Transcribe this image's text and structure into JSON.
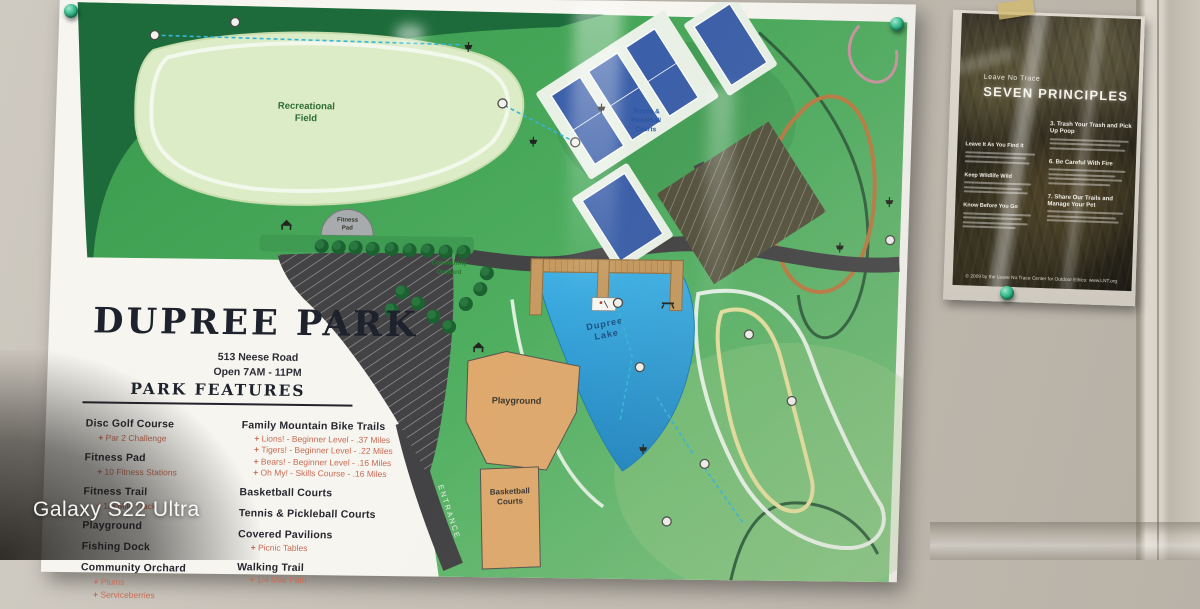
{
  "photo": {
    "watermark": "Galaxy S22 Ultra"
  },
  "board": {
    "title": "DUPREE PARK",
    "address": "513 Neese Road",
    "hours": "Open 7AM - 11PM",
    "features_heading": "PARK FEATURES",
    "features_left": [
      {
        "label": "Disc Golf Course",
        "subs": [
          "Par 2 Challenge"
        ]
      },
      {
        "label": "Fitness Pad",
        "subs": [
          "10 Fitness Stations"
        ]
      },
      {
        "label": "Fitness Trail",
        "subs": [
          "1/3 Mile Track"
        ]
      },
      {
        "label": "Playground",
        "subs": []
      },
      {
        "label": "Fishing Dock",
        "subs": []
      },
      {
        "label": "Community Orchard",
        "subs": [
          "Plums",
          "Serviceberries"
        ]
      }
    ],
    "features_right": [
      {
        "label": "Family Mountain Bike Trails",
        "subs": [
          "Lions! - Beginner Level - .37 Miles",
          "Tigers! - Beginner Level - .22 Miles",
          "Bears! - Beginner Level - .16 Miles",
          "Oh My! - Skills Course - .16 Miles"
        ]
      },
      {
        "label": "Basketball Courts",
        "subs": []
      },
      {
        "label": "Tennis & Pickleball Courts",
        "subs": []
      },
      {
        "label": "Covered Pavilions",
        "subs": [
          "Picnic Tables"
        ]
      },
      {
        "label": "Walking Trail",
        "subs": [
          "1/4 Mile Path"
        ]
      }
    ],
    "map_labels": {
      "field1": "Recreational",
      "field2": "Field",
      "tennis1": "Tennis &",
      "tennis2": "Pickleball",
      "tennis3": "Courts",
      "lake1": "Dupree",
      "lake2": "Lake",
      "playground": "Playground",
      "bball1": "Basketball",
      "bball2": "Courts",
      "fit1": "Fitness",
      "fit2": "Pad",
      "orch1": "Community",
      "orch2": "Orchard",
      "entrance": "ENTRANCE"
    },
    "colors": {
      "map_green": "#3d9a50",
      "lake_blue": "#2d9fd8",
      "court_blue": "#3b5fa9",
      "sand_tan": "#dfa96d",
      "road_gray": "#434345",
      "bullet_orange": "#c96a52"
    }
  },
  "poster": {
    "brand": "Leave No Trace",
    "title": "SEVEN PRINCIPLES",
    "left_headings": [
      "Leave It As You Find It",
      "Keep Wildlife Wild",
      "Know Before You Go"
    ],
    "right_headings": [
      "3. Trash Your Trash and Pick Up Poop",
      "6. Be Careful With Fire",
      "7. Share Our Trails and Manage Your Pet"
    ],
    "footer": "© 2009 by the Leave No Trace Center for Outdoor Ethics: www.LNT.org"
  }
}
